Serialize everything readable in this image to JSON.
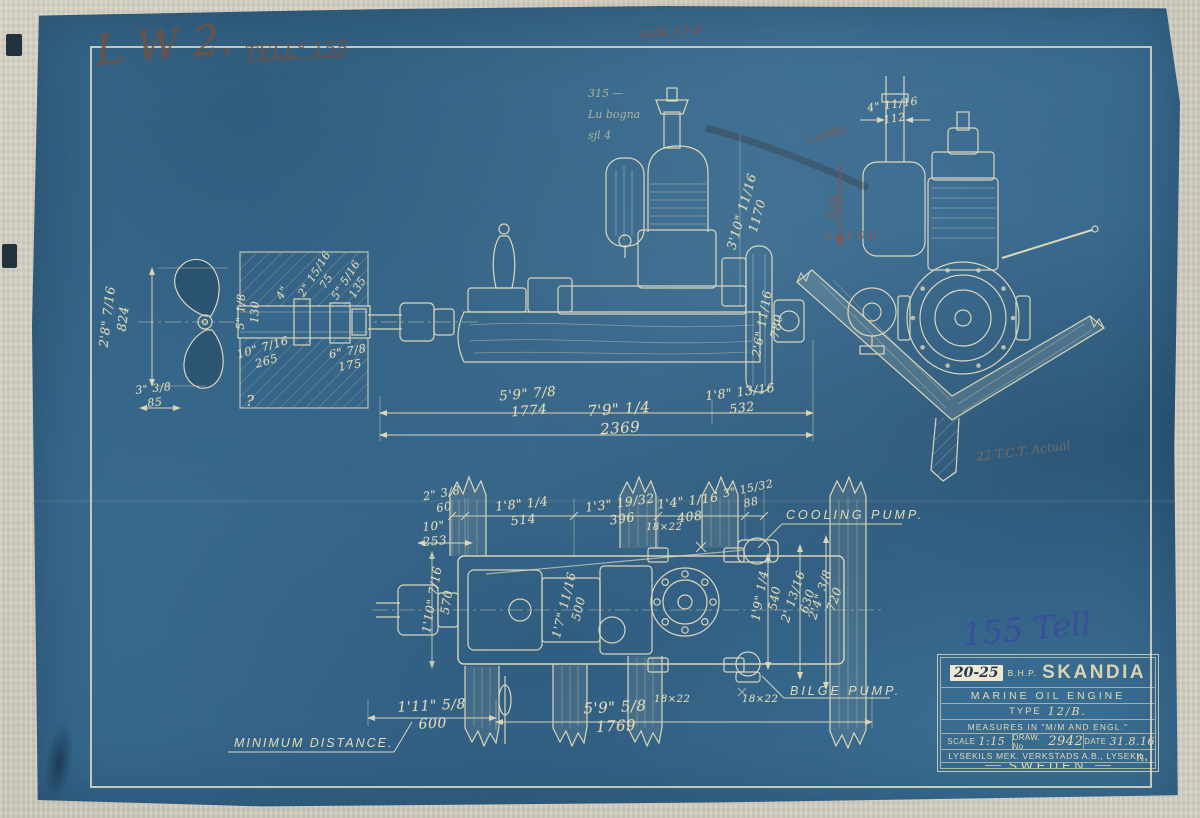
{
  "colors": {
    "blueprint_blue": "#3a6e90",
    "line_cream": "#e9e0bf",
    "ink_sepia": "#74503e",
    "ink_blue": "#3c4c9e",
    "pencil_red": "#95523e"
  },
  "annotations": {
    "initials_script": "L W 2.",
    "tell_note": "TELL° 155",
    "top_red_note": "mdk 17-8",
    "pencil_notes": "315 —\nLu bogna\nsjl 4",
    "red_l900": "L=900",
    "red_520": "520",
    "red_100": "≈ 100",
    "faint_note": "22 T.C.T. Actual",
    "blue_ink": "155 Tell",
    "signature": "n."
  },
  "callouts": {
    "cooling_pump": "COOLING PUMP.",
    "bilge_pump": "BILGE PUMP.",
    "minimum_distance": "MINIMUM DISTANCE."
  },
  "dims": {
    "prop": "2'8\" 7/16\n824",
    "d85": "3\" 3/8\n85",
    "s130": "5\" 1/8\n130",
    "s4": "4\"",
    "s75": "2\" 15/16\n75",
    "s135": "5\" 5/16\n135",
    "s265": "10\" 7/16\n265",
    "s175": "6\" 7/8\n175",
    "q": "?",
    "d1774": "5'9\" 7/8\n1774",
    "d2369": "7'9\" 1/4\n2369",
    "d532": "1'8\" 13/16\n532",
    "d780": "2'6\" 11/16\n780",
    "d1170": "3'10\" 11/16\n1170",
    "d112": "4\" 11/16\n112",
    "p60": "2\" 3/8\n60",
    "p253": "10\"\n253",
    "p514": "1'8\" 1/4\n514",
    "p396": "1'3\" 19/32\n396",
    "p408": "1'4\" 1/16\n408",
    "p88": "3\" 15/32\n88",
    "p540": "1'9\" 1/4\n540",
    "p630": "2' 13/16\n630",
    "p720": "2'4\" 3/8\n720",
    "p570": "1'10\" 7/16\n570",
    "p500": "1'7\" 11/16\n500",
    "p600": "1'11\" 5/8\n600",
    "p1769": "5'9\" 5/8\n1769",
    "bolt1": "18×22",
    "bolt2": "18×22",
    "bolt3": "18×22"
  },
  "title_block": {
    "power": "20-25",
    "bhp": "B.H.P.",
    "brand": "SKANDIA",
    "line2": "MARINE OIL ENGINE",
    "type_label": "TYPE",
    "type_value": "12/B.",
    "measures": "MEASURES IN \"M/M AND ENGL.\"",
    "scale_label": "SCALE",
    "scale_value": "1:15",
    "draw_label": "DRAW. No",
    "draw_value": "2942",
    "date_label": "DATE",
    "date_value": "31.8.16",
    "company": "LYSEKILS MEK. VERKSTADS A.B., LYSEKIL,",
    "country": "SWEDEN"
  }
}
